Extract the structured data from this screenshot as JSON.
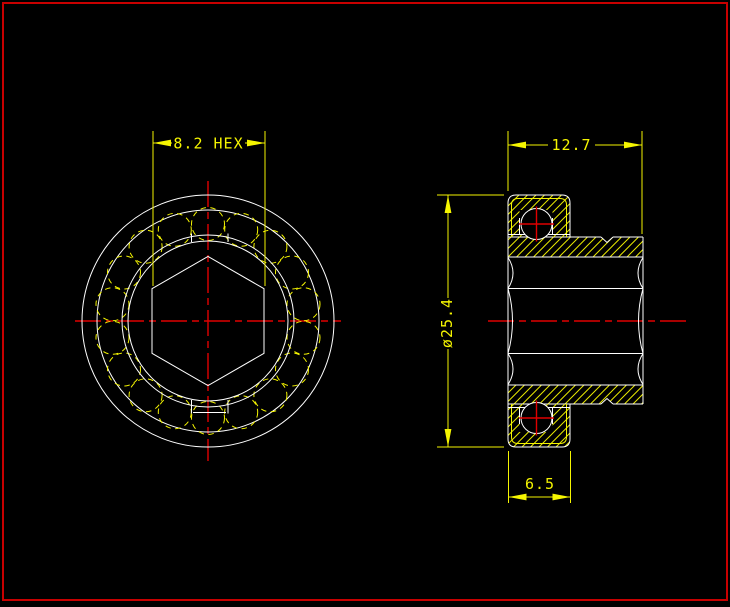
{
  "dimensions": {
    "hex_width": "8.2 HEX",
    "overall_width": "12.7",
    "outer_diameter": "ø25.4",
    "shell_width": "6.5"
  },
  "colors": {
    "background": "#000000",
    "border": "#c80000",
    "outline": "#ffffff",
    "annotation": "#f5f500",
    "centerline": "#e00000"
  },
  "geometry_note": ""
}
